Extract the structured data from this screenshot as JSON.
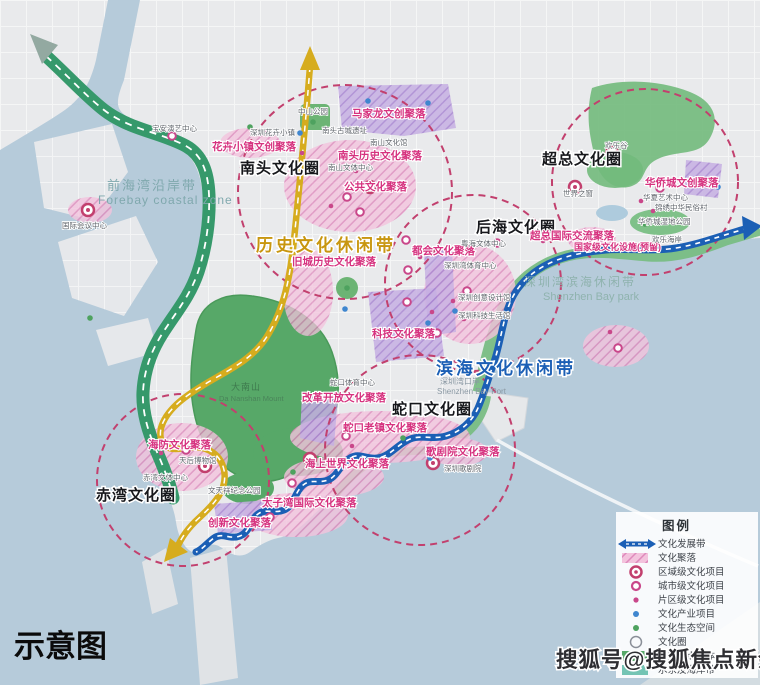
{
  "map": {
    "caption": "示意图",
    "watermark": "搜狐号@搜狐焦点新余站"
  },
  "belts": {
    "history": "历史文化休闲带",
    "coastal": "滨海文化休闲带",
    "forebay_cn": "前海湾沿岸带",
    "forebay_en": "Forebay coastal zone",
    "szbay_cn": "深圳湾滨海休闲带",
    "szbay_en": "Shenzhen Bay park"
  },
  "circles": [
    "南头文化圈",
    "超总文化圈",
    "后海文化圈",
    "蛇口文化圈",
    "赤湾文化圈"
  ],
  "clusters": [
    "花卉小镇文创聚落",
    "马家龙文创聚落",
    "南头历史文化聚落",
    "公共文化聚落",
    "旧城历史文化聚落",
    "科技文化聚落",
    "都会文化聚落",
    "超总国际交流聚落",
    "国家级文化设施(预留)",
    "华侨城文创聚落",
    "改革开放文化聚落",
    "蛇口老镇文化聚落",
    "海上世界文化聚落",
    "太子湾国际文化聚落",
    "歌剧院文化聚落",
    "海防文化聚落",
    "创新文化聚落"
  ],
  "landmarks": {
    "mountain_cn": "大南山",
    "mountain_en": "Da Nanshan Mount",
    "port_cn": "深圳湾口岸",
    "port_en": "Shenzhen Bay Port"
  },
  "pois": [
    "国际会议中心",
    "宝安演艺中心",
    "深圳花卉小镇",
    "中山公园",
    "南头古城遗址",
    "南山文化馆",
    "南山文体中心",
    "欢乐谷",
    "世界之窗",
    "华夏艺术中心",
    "锦绣中华民俗村",
    "华侨城湿地公园",
    "欢乐海岸",
    "粤海文体中心",
    "深圳湾体育中心",
    "深圳创意设计馆",
    "深圳科技生活馆",
    "蛇口体育中心",
    "深圳歌剧院",
    "天后博物馆",
    "赤湾文体中心",
    "文天祥纪念公园"
  ],
  "legend": {
    "title": "图例",
    "items": [
      "文化发展带",
      "文化聚落",
      "区域级文化项目",
      "城市级文化项目",
      "片区级文化项目",
      "文化产业项目",
      "文化生态空间",
      "文化圈",
      "重要节点山体",
      "水系及海岸带"
    ]
  },
  "colors": {
    "water": "#b6cbda",
    "land": "#e9eaec",
    "park_green": "#57a868",
    "belt_green": "#36996b",
    "belt_gold": "#d6ac1e",
    "belt_blue": "#1b5fb5",
    "circle_dash": "#c2406e",
    "cluster_pink": "#d6327f"
  }
}
